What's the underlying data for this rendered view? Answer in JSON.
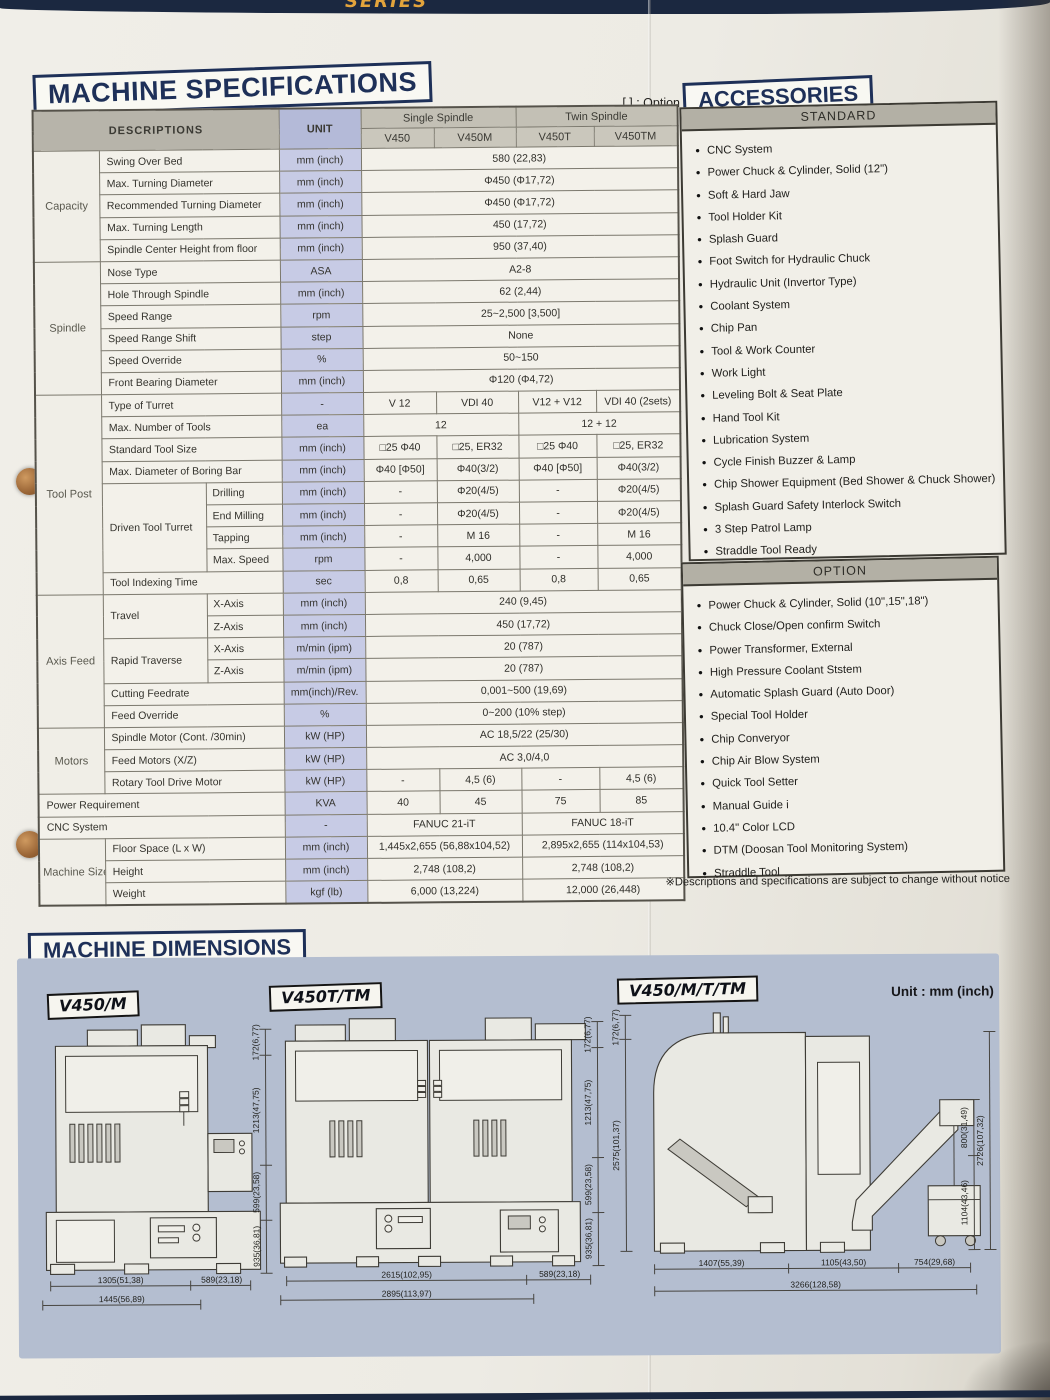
{
  "top_banner": {
    "text": "SERIES"
  },
  "spec": {
    "title": "MACHINE SPECIFICATIONS",
    "option_legend": "[ ] : Option"
  },
  "spec_table": {
    "header": {
      "descriptions": "DESCRIPTIONS",
      "unit": "UNIT",
      "single_spindle": "Single Spindle",
      "twin_spindle": "Twin Spindle",
      "models": [
        "V450",
        "V450M",
        "V450T",
        "V450TM"
      ]
    },
    "col_widths": [
      66,
      104,
      76,
      82,
      73,
      82,
      78,
      84
    ],
    "rows": [
      {
        "cells": [
          {
            "t": "Capacity",
            "rs": 5,
            "c": "g"
          },
          {
            "t": "Swing Over Bed",
            "cs": 2,
            "c": "d"
          },
          {
            "t": "mm (inch)",
            "c": "u"
          },
          {
            "t": "580 (22,83)",
            "cs": 4,
            "c": "v"
          }
        ]
      },
      {
        "cells": [
          {
            "t": "Max. Turning Diameter",
            "cs": 2,
            "c": "d"
          },
          {
            "t": "mm (inch)",
            "c": "u"
          },
          {
            "t": "Φ450 (Φ17,72)",
            "cs": 4,
            "c": "v"
          }
        ]
      },
      {
        "cells": [
          {
            "t": "Recommended Turning Diameter",
            "cs": 2,
            "c": "d"
          },
          {
            "t": "mm (inch)",
            "c": "u"
          },
          {
            "t": "Φ450 (Φ17,72)",
            "cs": 4,
            "c": "v"
          }
        ]
      },
      {
        "cells": [
          {
            "t": "Max. Turning Length",
            "cs": 2,
            "c": "d"
          },
          {
            "t": "mm (inch)",
            "c": "u"
          },
          {
            "t": "450 (17,72)",
            "cs": 4,
            "c": "v"
          }
        ]
      },
      {
        "cells": [
          {
            "t": "Spindle Center Height from floor",
            "cs": 2,
            "c": "d"
          },
          {
            "t": "mm (inch)",
            "c": "u"
          },
          {
            "t": "950 (37,40)",
            "cs": 4,
            "c": "v"
          }
        ]
      },
      {
        "cells": [
          {
            "t": "Spindle",
            "rs": 6,
            "c": "g"
          },
          {
            "t": "Nose Type",
            "cs": 2,
            "c": "d"
          },
          {
            "t": "ASA",
            "c": "u"
          },
          {
            "t": "A2-8",
            "cs": 4,
            "c": "v"
          }
        ]
      },
      {
        "cells": [
          {
            "t": "Hole Through Spindle",
            "cs": 2,
            "c": "d"
          },
          {
            "t": "mm (inch)",
            "c": "u"
          },
          {
            "t": "62 (2,44)",
            "cs": 4,
            "c": "v"
          }
        ]
      },
      {
        "cells": [
          {
            "t": "Speed Range",
            "cs": 2,
            "c": "d"
          },
          {
            "t": "rpm",
            "c": "u"
          },
          {
            "t": "25~2,500 [3,500]",
            "cs": 4,
            "c": "v"
          }
        ]
      },
      {
        "cells": [
          {
            "t": "Speed Range Shift",
            "cs": 2,
            "c": "d"
          },
          {
            "t": "step",
            "c": "u"
          },
          {
            "t": "None",
            "cs": 4,
            "c": "v"
          }
        ]
      },
      {
        "cells": [
          {
            "t": "Speed Override",
            "cs": 2,
            "c": "d"
          },
          {
            "t": "%",
            "c": "u"
          },
          {
            "t": "50~150",
            "cs": 4,
            "c": "v"
          }
        ]
      },
      {
        "cells": [
          {
            "t": "Front Bearing Diameter",
            "cs": 2,
            "c": "d"
          },
          {
            "t": "mm (inch)",
            "c": "u"
          },
          {
            "t": "Φ120 (Φ4,72)",
            "cs": 4,
            "c": "v"
          }
        ]
      },
      {
        "cells": [
          {
            "t": "Tool Post",
            "rs": 9,
            "c": "g"
          },
          {
            "t": "Type of Turret",
            "cs": 2,
            "c": "d"
          },
          {
            "t": "-",
            "c": "u"
          },
          {
            "t": "V 12",
            "c": "v"
          },
          {
            "t": "VDI 40",
            "c": "v"
          },
          {
            "t": "V12 + V12",
            "c": "v"
          },
          {
            "t": "VDI 40 (2sets)",
            "c": "v"
          }
        ]
      },
      {
        "cells": [
          {
            "t": "Max. Number of Tools",
            "cs": 2,
            "c": "d"
          },
          {
            "t": "ea",
            "c": "u"
          },
          {
            "t": "12",
            "cs": 2,
            "c": "v"
          },
          {
            "t": "12 + 12",
            "cs": 2,
            "c": "v"
          }
        ]
      },
      {
        "cells": [
          {
            "t": "Standard Tool Size",
            "cs": 2,
            "c": "d"
          },
          {
            "t": "mm (inch)",
            "c": "u"
          },
          {
            "t": "□25 Φ40",
            "c": "v"
          },
          {
            "t": "□25, ER32",
            "c": "v"
          },
          {
            "t": "□25 Φ40",
            "c": "v"
          },
          {
            "t": "□25, ER32",
            "c": "v"
          }
        ]
      },
      {
        "cells": [
          {
            "t": "Max. Diameter of Boring Bar",
            "cs": 2,
            "c": "d"
          },
          {
            "t": "mm (inch)",
            "c": "u"
          },
          {
            "t": "Φ40 [Φ50]",
            "c": "v"
          },
          {
            "t": "Φ40(3/2)",
            "c": "v"
          },
          {
            "t": "Φ40 [Φ50]",
            "c": "v"
          },
          {
            "t": "Φ40(3/2)",
            "c": "v"
          }
        ]
      },
      {
        "cells": [
          {
            "t": "Driven Tool Turret",
            "rs": 4,
            "c": "d"
          },
          {
            "t": "Drilling",
            "c": "d2"
          },
          {
            "t": "mm (inch)",
            "c": "u"
          },
          {
            "t": "-",
            "c": "v"
          },
          {
            "t": "Φ20(4/5)",
            "c": "v"
          },
          {
            "t": "-",
            "c": "v"
          },
          {
            "t": "Φ20(4/5)",
            "c": "v"
          }
        ]
      },
      {
        "cells": [
          {
            "t": "End Milling",
            "c": "d2"
          },
          {
            "t": "mm (inch)",
            "c": "u"
          },
          {
            "t": "-",
            "c": "v"
          },
          {
            "t": "Φ20(4/5)",
            "c": "v"
          },
          {
            "t": "-",
            "c": "v"
          },
          {
            "t": "Φ20(4/5)",
            "c": "v"
          }
        ]
      },
      {
        "cells": [
          {
            "t": "Tapping",
            "c": "d2"
          },
          {
            "t": "mm (inch)",
            "c": "u"
          },
          {
            "t": "-",
            "c": "v"
          },
          {
            "t": "M 16",
            "c": "v"
          },
          {
            "t": "-",
            "c": "v"
          },
          {
            "t": "M 16",
            "c": "v"
          }
        ]
      },
      {
        "cells": [
          {
            "t": "Max. Speed",
            "c": "d2"
          },
          {
            "t": "rpm",
            "c": "u"
          },
          {
            "t": "-",
            "c": "v"
          },
          {
            "t": "4,000",
            "c": "v"
          },
          {
            "t": "-",
            "c": "v"
          },
          {
            "t": "4,000",
            "c": "v"
          }
        ]
      },
      {
        "cells": [
          {
            "t": "Tool Indexing Time",
            "cs": 2,
            "c": "d"
          },
          {
            "t": "sec",
            "c": "u"
          },
          {
            "t": "0,8",
            "c": "v"
          },
          {
            "t": "0,65",
            "c": "v"
          },
          {
            "t": "0,8",
            "c": "v"
          },
          {
            "t": "0,65",
            "c": "v"
          }
        ]
      },
      {
        "cells": [
          {
            "t": "Axis Feed",
            "rs": 6,
            "c": "g"
          },
          {
            "t": "Travel",
            "rs": 2,
            "c": "d"
          },
          {
            "t": "X-Axis",
            "c": "d2"
          },
          {
            "t": "mm (inch)",
            "c": "u"
          },
          {
            "t": "240 (9,45)",
            "cs": 4,
            "c": "v"
          }
        ]
      },
      {
        "cells": [
          {
            "t": "Z-Axis",
            "c": "d2"
          },
          {
            "t": "mm (inch)",
            "c": "u"
          },
          {
            "t": "450 (17,72)",
            "cs": 4,
            "c": "v"
          }
        ]
      },
      {
        "cells": [
          {
            "t": "Rapid Traverse",
            "rs": 2,
            "c": "d"
          },
          {
            "t": "X-Axis",
            "c": "d2"
          },
          {
            "t": "m/min (ipm)",
            "c": "u"
          },
          {
            "t": "20 (787)",
            "cs": 4,
            "c": "v"
          }
        ]
      },
      {
        "cells": [
          {
            "t": "Z-Axis",
            "c": "d2"
          },
          {
            "t": "m/min (ipm)",
            "c": "u"
          },
          {
            "t": "20 (787)",
            "cs": 4,
            "c": "v"
          }
        ]
      },
      {
        "cells": [
          {
            "t": "Cutting Feedrate",
            "cs": 2,
            "c": "d"
          },
          {
            "t": "mm(inch)/Rev.",
            "c": "u"
          },
          {
            "t": "0,001~500 (19,69)",
            "cs": 4,
            "c": "v"
          }
        ]
      },
      {
        "cells": [
          {
            "t": "Feed Override",
            "cs": 2,
            "c": "d"
          },
          {
            "t": "%",
            "c": "u"
          },
          {
            "t": "0~200 (10% step)",
            "cs": 4,
            "c": "v"
          }
        ]
      },
      {
        "cells": [
          {
            "t": "Motors",
            "rs": 3,
            "c": "g"
          },
          {
            "t": "Spindle Motor (Cont. /30min)",
            "cs": 2,
            "c": "d"
          },
          {
            "t": "kW (HP)",
            "c": "u"
          },
          {
            "t": "AC 18,5/22 (25/30)",
            "cs": 4,
            "c": "v"
          }
        ]
      },
      {
        "cells": [
          {
            "t": "Feed Motors (X/Z)",
            "cs": 2,
            "c": "d"
          },
          {
            "t": "kW (HP)",
            "c": "u"
          },
          {
            "t": "AC 3,0/4,0",
            "cs": 4,
            "c": "v"
          }
        ]
      },
      {
        "cells": [
          {
            "t": "Rotary Tool Drive Motor",
            "cs": 2,
            "c": "d"
          },
          {
            "t": "kW (HP)",
            "c": "u"
          },
          {
            "t": "-",
            "c": "v"
          },
          {
            "t": "4,5 (6)",
            "c": "v"
          },
          {
            "t": "-",
            "c": "v"
          },
          {
            "t": "4,5 (6)",
            "c": "v"
          }
        ]
      },
      {
        "cells": [
          {
            "t": "Power Requirement",
            "cs": 3,
            "c": "d"
          },
          {
            "t": "KVA",
            "c": "u"
          },
          {
            "t": "40",
            "c": "v"
          },
          {
            "t": "45",
            "c": "v"
          },
          {
            "t": "75",
            "c": "v"
          },
          {
            "t": "85",
            "c": "v"
          }
        ]
      },
      {
        "cells": [
          {
            "t": "CNC System",
            "cs": 3,
            "c": "d"
          },
          {
            "t": "-",
            "c": "u"
          },
          {
            "t": "FANUC 21-iT",
            "cs": 2,
            "c": "v"
          },
          {
            "t": "FANUC 18-iT",
            "cs": 2,
            "c": "v"
          }
        ]
      },
      {
        "cells": [
          {
            "t": "Machine Size",
            "rs": 3,
            "c": "g"
          },
          {
            "t": "Floor Space (L x W)",
            "cs": 2,
            "c": "d"
          },
          {
            "t": "mm (inch)",
            "c": "u"
          },
          {
            "t": "1,445x2,655 (56,88x104,52)",
            "cs": 2,
            "c": "v"
          },
          {
            "t": "2,895x2,655 (114x104,53)",
            "cs": 2,
            "c": "v"
          }
        ]
      },
      {
        "cells": [
          {
            "t": "Height",
            "cs": 2,
            "c": "d"
          },
          {
            "t": "mm (inch)",
            "c": "u"
          },
          {
            "t": "2,748 (108,2)",
            "cs": 2,
            "c": "v"
          },
          {
            "t": "2,748 (108,2)",
            "cs": 2,
            "c": "v"
          }
        ]
      },
      {
        "cells": [
          {
            "t": "Weight",
            "cs": 2,
            "c": "d"
          },
          {
            "t": "kgf (lb)",
            "c": "u"
          },
          {
            "t": "6,000 (13,224)",
            "cs": 2,
            "c": "v"
          },
          {
            "t": "12,000 (26,448)",
            "cs": 2,
            "c": "v"
          }
        ]
      }
    ]
  },
  "accessories": {
    "title": "ACCESSORIES",
    "standard_label": "STANDARD",
    "option_label": "OPTION",
    "standard_items": [
      "CNC System",
      "Power Chuck & Cylinder, Solid (12\")",
      "Soft & Hard Jaw",
      "Tool Holder Kit",
      "Splash Guard",
      "Foot Switch for Hydraulic Chuck",
      "Hydraulic Unit (Invertor Type)",
      "Coolant System",
      "Chip Pan",
      "Tool & Work Counter",
      "Work Light",
      "Leveling Bolt & Seat Plate",
      "Hand Tool Kit",
      "Lubrication System",
      "Cycle Finish Buzzer & Lamp",
      "Chip Shower Equipment (Bed Shower & Chuck Shower)",
      "Splash Guard Safety Interlock Switch",
      "3 Step Patrol Lamp",
      "Straddle Tool Ready"
    ],
    "option_items": [
      "Power Chuck & Cylinder, Solid (10\",15\",18\")",
      "Chuck Close/Open confirm Switch",
      "Power Transformer, External",
      "High Pressure Coolant Ststem",
      "Automatic Splash Guard (Auto Door)",
      "Special Tool Holder",
      "Chip Converyor",
      "Chip Air Blow System",
      "Quick Tool Setter",
      "Manual Guide i",
      "10.4\" Color LCD",
      "DTM (Doosan Tool Monitoring System)",
      "Straddle Tool"
    ],
    "footnote": "※Descriptions and specifications are subject to change without notice"
  },
  "dimensions": {
    "title": "MACHINE DIMENSIONS",
    "unit_note": "Unit : mm (inch)",
    "diagrams": [
      {
        "label": "V450/M",
        "vertical": [
          "172(6,77)",
          "1213(47,75)",
          "599(23,58)",
          "935(36,81)"
        ],
        "horizontal": [
          "1305(51,38)",
          "589(23,18)",
          "1445(56,89)"
        ]
      },
      {
        "label": "V450T/TM",
        "vertical": [
          "172(6,77)",
          "1213(47,75)",
          "599(23,58)",
          "935(36,81)"
        ],
        "horizontal": [
          "2615(102,95)",
          "589(23,18)",
          "2895(113,97)"
        ]
      },
      {
        "label": "V450/M/T/TM",
        "vertical_left": [
          "172(6,77)",
          "2575(101,37)"
        ],
        "vertical_right": [
          "800(31,49)",
          "1104(43,46)",
          "2726(107,32)"
        ],
        "horizontal": [
          "1407(55,39)",
          "1105(43,50)",
          "754(29,68)",
          "3266(128,58)"
        ]
      }
    ]
  }
}
